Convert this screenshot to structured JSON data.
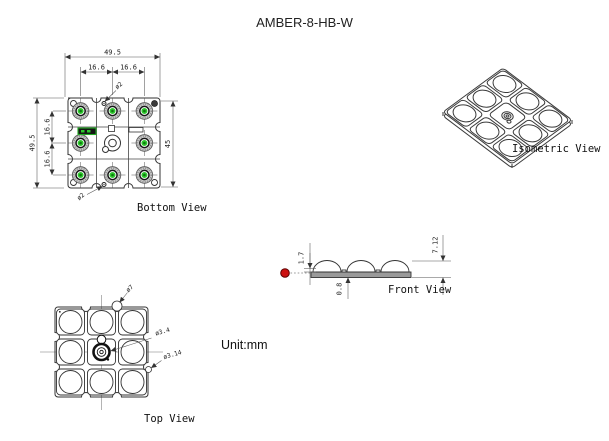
{
  "title": "AMBER-8-HB-W",
  "unit_note": "Unit:mm",
  "views": {
    "bottom": {
      "label": "Bottom View",
      "dims": {
        "overall_width": "49.5",
        "pitch_left": "16.6",
        "pitch_right": "16.6",
        "overall_height": "49.5",
        "pitch_top": "16.6",
        "pitch_bottom": "16.6",
        "hole_span": "45",
        "hole_top": "ø2",
        "hole_bottom": "ø2"
      }
    },
    "isometric": {
      "label": "Isometric View"
    },
    "front": {
      "label": "Front View",
      "dims": {
        "standoff": "1.7",
        "total_height": "7.12",
        "board_thickness": "0.8"
      }
    },
    "top": {
      "label": "Top View",
      "dims": {
        "lens_diameter": "ø7",
        "center_hole": "ø3.4",
        "pad_diameter": "ø3.14"
      }
    }
  },
  "colors": {
    "line": "#333333",
    "led_green": "#2dc82d",
    "led_core_green": "#0f7a0f",
    "pcb_label_green": "#22aa22",
    "datum_red": "#cc1111",
    "board_gray": "#9a9a9a"
  }
}
